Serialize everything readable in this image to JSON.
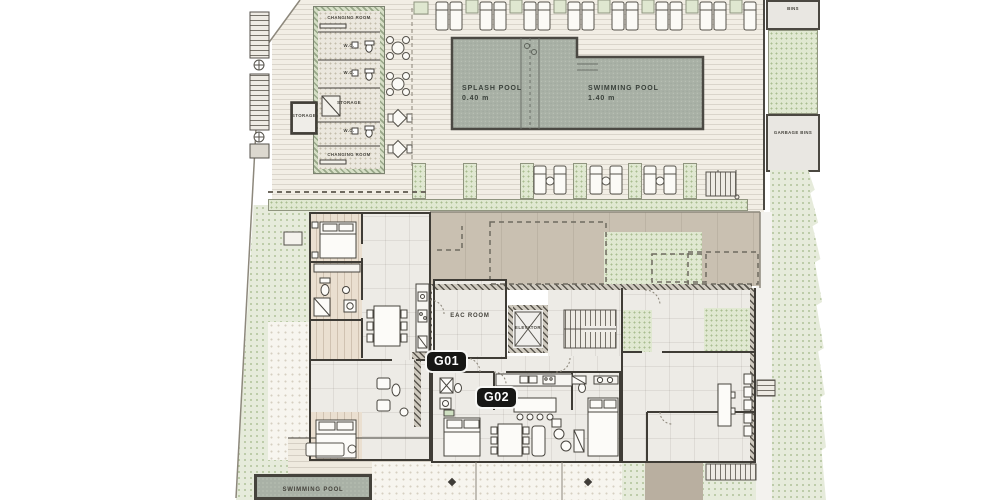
{
  "plan": {
    "name": "ground-floor-site-plan",
    "units": [
      {
        "id": "G01"
      },
      {
        "id": "G02"
      }
    ],
    "pools": {
      "splash": {
        "label": "SPLASH POOL",
        "depth": "0.40 m"
      },
      "main": {
        "label": "SWIMMING POOL",
        "depth": "1.40 m"
      },
      "private": {
        "label": "SWIMMING POOL"
      }
    },
    "rooms": {
      "changing_room_top": "CHANGING ROOM",
      "wc_1": "W.C.",
      "wc_2": "W.C.",
      "storage": "STORAGE",
      "storage_annex": "STORAGE",
      "wc_3": "W.C.",
      "changing_room_bottom": "CHANGING ROOM",
      "bins_top": "BINS",
      "garbage_bins": "GARBAGE BINS",
      "eac": "EAC ROOM",
      "elevator": "ELEVATOR"
    },
    "colors": {
      "deck": "#f2eee5",
      "pool": "#a9b1a6",
      "planter": "#e0e8d1",
      "terrace": "#c9c0b1",
      "wall": "#45423b",
      "badge_bg": "#171715",
      "badge_text": "#ffffff"
    }
  }
}
